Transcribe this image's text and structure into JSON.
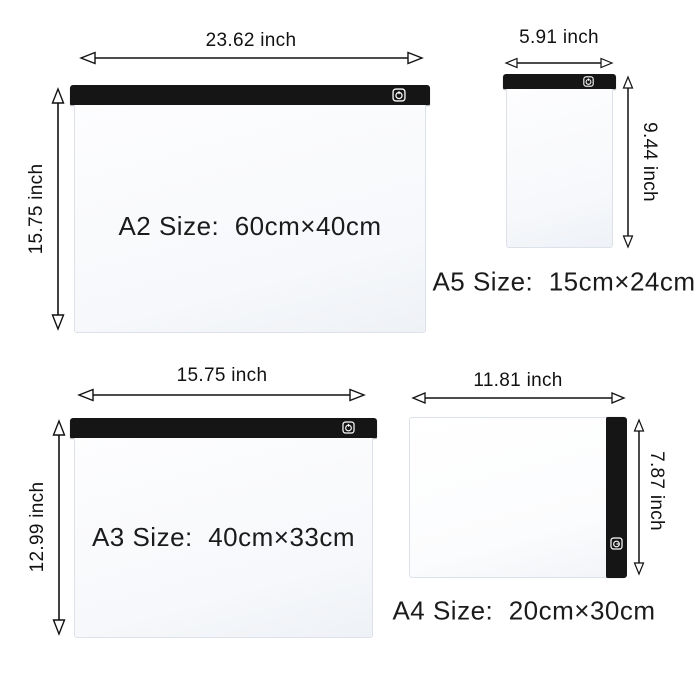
{
  "diagram_title": "LED light pad size comparison",
  "colors": {
    "background": "#ffffff",
    "bar": "#151515",
    "board_border": "#dde1e9",
    "text": "#1b1b1b",
    "arrow": "#111111"
  },
  "boards": {
    "a2": {
      "size_label": "A2 Size:  60cm×40cm",
      "width_label": "23.62 inch",
      "height_label": "15.75 inch"
    },
    "a5": {
      "size_label": "A5 Size:  15cm×24cm",
      "width_label": "5.91 inch",
      "height_label": "9.44 inch"
    },
    "a3": {
      "size_label": "A3 Size:  40cm×33cm",
      "width_label": "15.75 inch",
      "height_label": "12.99 inch"
    },
    "a4": {
      "size_label": "A4 Size:  20cm×30cm",
      "width_label": "11.81 inch",
      "height_label": "7.87 inch"
    }
  }
}
